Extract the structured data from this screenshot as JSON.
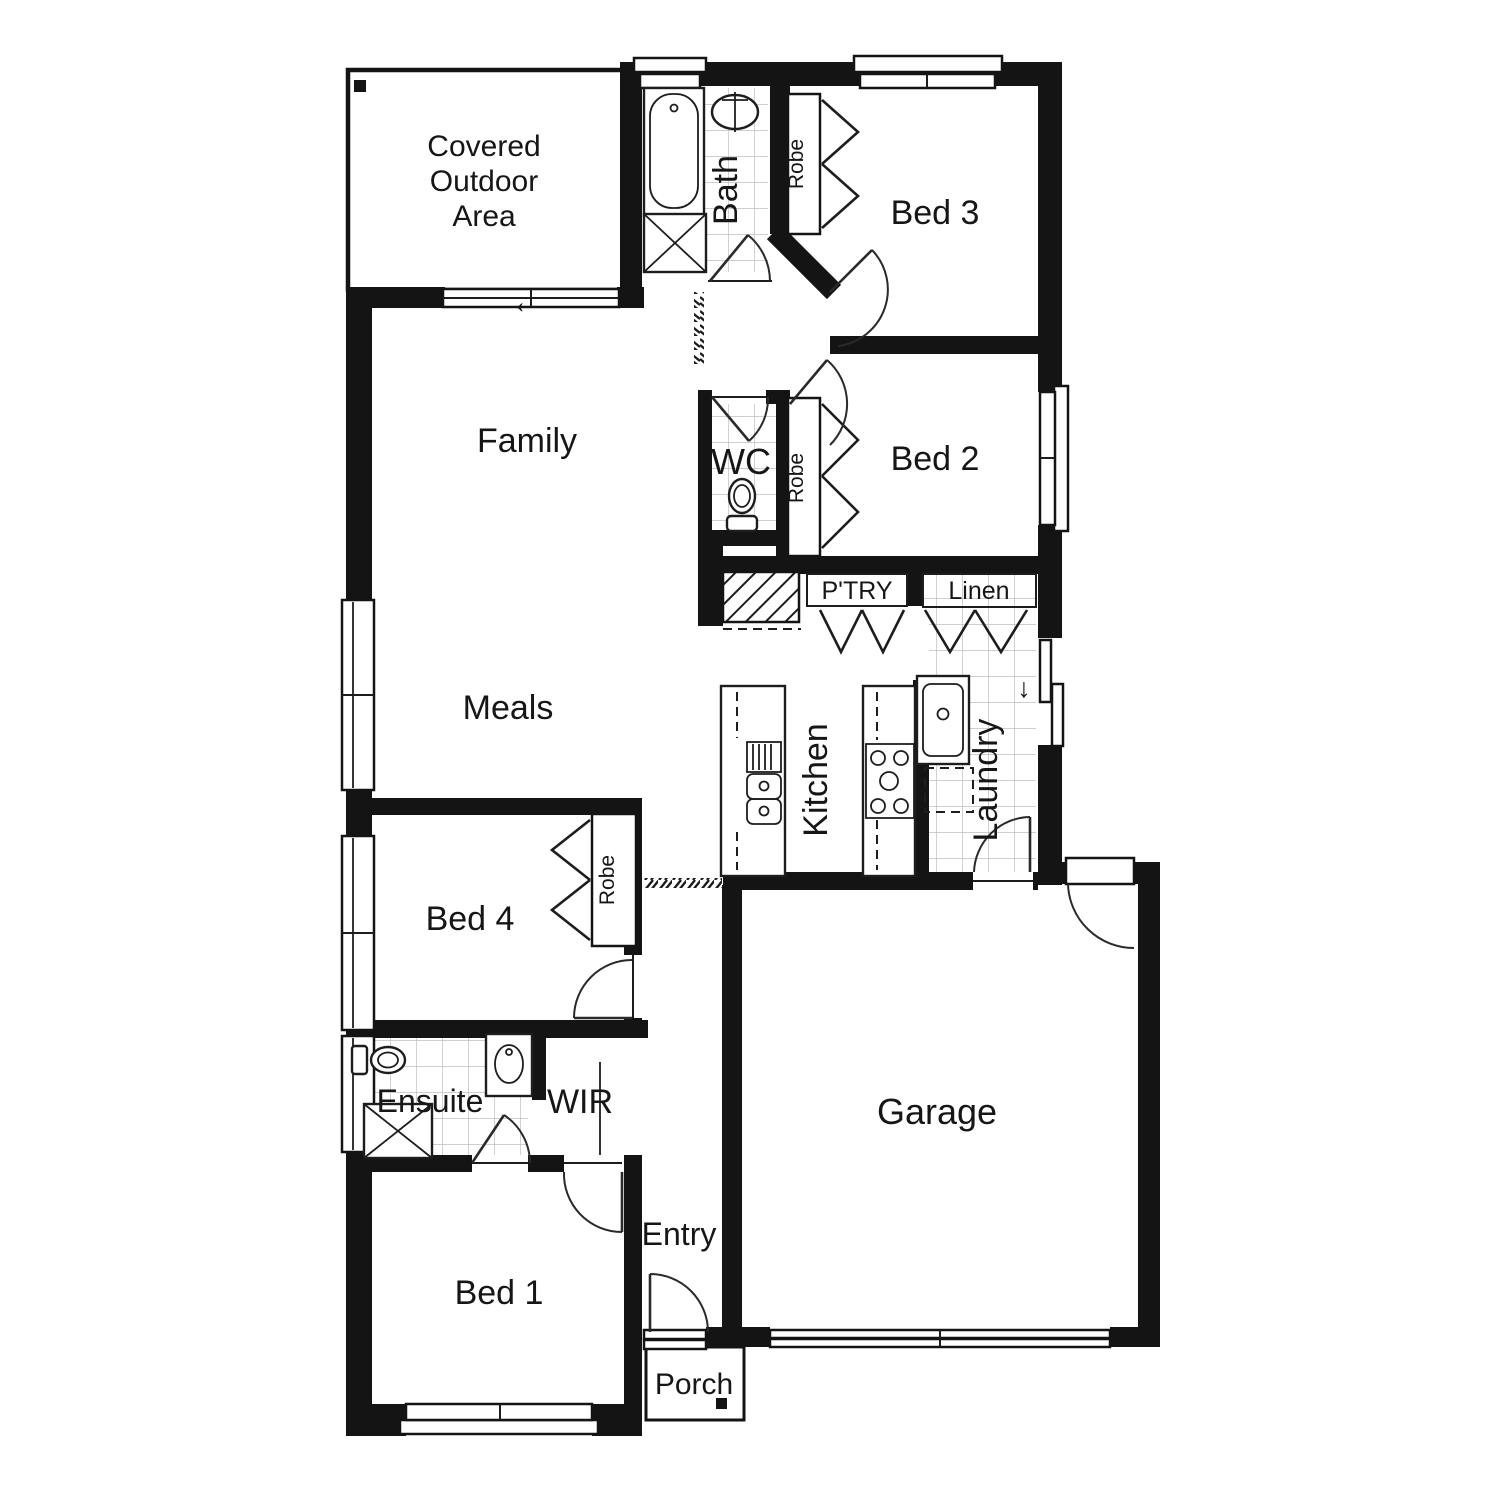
{
  "title": "Single storey house floor plan",
  "colors": {
    "walls": "#141414",
    "lines": "#2a2a2a",
    "tiles": "#c3c3c3",
    "background": "#ffffff"
  },
  "labels": {
    "covered1": "Covered",
    "covered2": "Outdoor",
    "covered3": "Area",
    "bath": "Bath",
    "robe": "Robe",
    "bed3": "Bed 3",
    "bed2": "Bed 2",
    "wc": "WC",
    "ptry": "P'TRY",
    "linen": "Linen",
    "family": "Family",
    "meals": "Meals",
    "kitchen": "Kitchen",
    "laundry": "Laundry",
    "bed4": "Bed 4",
    "ensuite": "Ensuite",
    "wir": "WIR",
    "bed1": "Bed 1",
    "entry": "Entry",
    "garage": "Garage",
    "porch": "Porch"
  },
  "icons": {
    "slider_arrow": "←",
    "step_arrow": "↓"
  }
}
